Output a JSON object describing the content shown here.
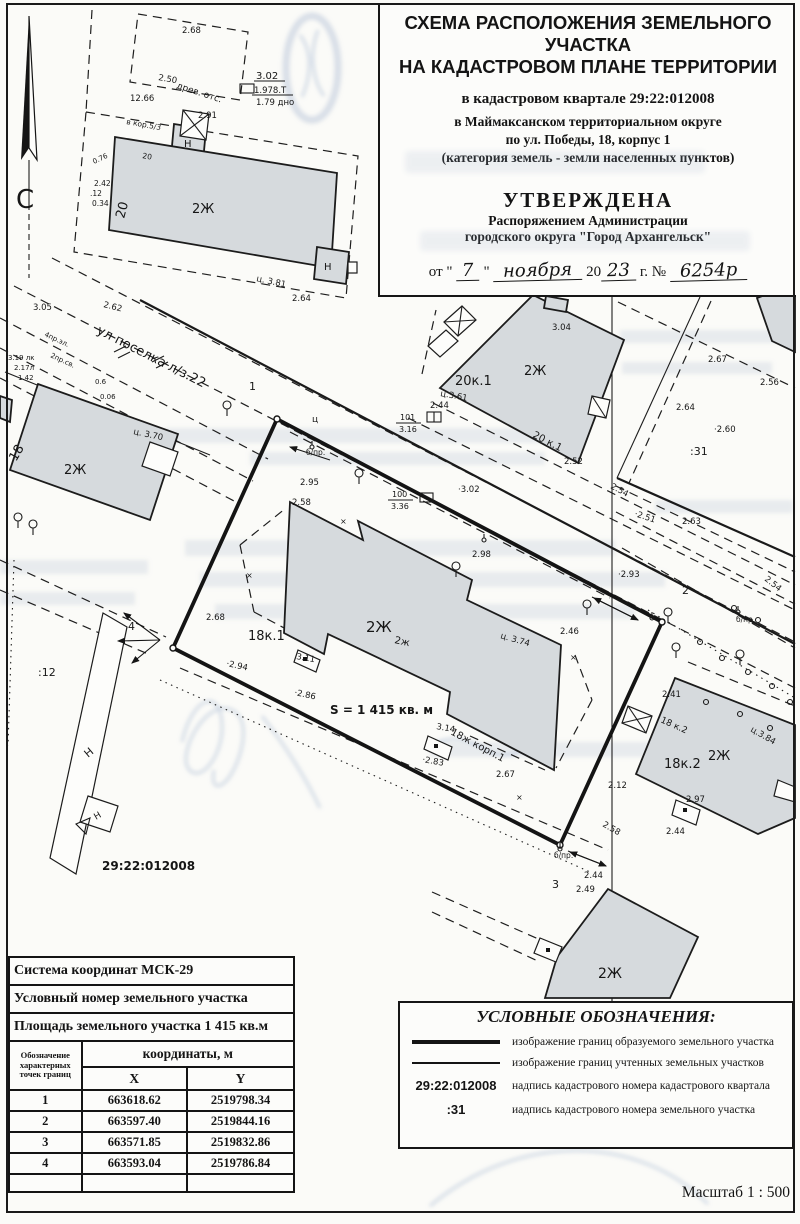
{
  "header": {
    "title_line1": "СХЕМА РАСПОЛОЖЕНИЯ ЗЕМЕЛЬНОГО УЧАСТКА",
    "title_line2": "НА КАДАСТРОВОМ ПЛАНЕ ТЕРРИТОРИИ",
    "subtitle_quarter": "в кадастровом квартале 29:22:012008",
    "subtitle_district": "в Маймаксанском территориальном округе",
    "subtitle_address": "по ул. Победы, 18, корпус 1",
    "subtitle_category": "(категория земель - земли населенных пунктов)",
    "approved_title": "УТВЕРЖДЕНА",
    "approved_line1": "Распоряжением Администрации",
    "approved_line2": "городского округа \"Город Архангельск\"",
    "date_prefix": "от \"",
    "date_day": "7",
    "date_quote": "\"",
    "date_month": "ноября",
    "date_year_prefix": "20",
    "date_year": "23",
    "date_suffix": "г. №",
    "date_number": "6254р"
  },
  "map": {
    "north_letter": "С",
    "labels": [
      {
        "t": "2.68",
        "x": 182,
        "y": 33
      },
      {
        "t": "3.02",
        "x": 256,
        "y": 79,
        "s": 10
      },
      {
        "t": "1.978.Т",
        "x": 254,
        "y": 93
      },
      {
        "t": "1.79 дно",
        "x": 256,
        "y": 105
      },
      {
        "t": "2.50",
        "x": 158,
        "y": 80,
        "r": 10
      },
      {
        "t": "древ. отс.",
        "x": 176,
        "y": 88,
        "r": 18,
        "s": 9
      },
      {
        "t": "12.66",
        "x": 130,
        "y": 101
      },
      {
        "t": "в кор.5/3",
        "x": 126,
        "y": 124,
        "r": 10,
        "s": 7.5
      },
      {
        "t": "2.91",
        "x": 198,
        "y": 118
      },
      {
        "t": "Н",
        "x": 184,
        "y": 147,
        "s": 10
      },
      {
        "t": "20",
        "x": 142,
        "y": 158,
        "s": 7.5,
        "r": 10
      },
      {
        "t": "20",
        "x": 124,
        "y": 219,
        "s": 13,
        "r": -75
      },
      {
        "t": "2Ж",
        "x": 192,
        "y": 213,
        "s": 13
      },
      {
        "t": "Н",
        "x": 324,
        "y": 270,
        "s": 10
      },
      {
        "t": "ц. 3.81",
        "x": 256,
        "y": 281,
        "r": 12
      },
      {
        "t": "2.64",
        "x": 292,
        "y": 301
      },
      {
        "t": "С",
        "x": 16,
        "y": 208,
        "s": 26
      },
      {
        "t": "0.76",
        "x": 94,
        "y": 164,
        "s": 7,
        "r": -25
      },
      {
        "t": "2.42",
        "x": 94,
        "y": 186,
        "s": 7.5
      },
      {
        "t": ".12",
        "x": 90,
        "y": 196,
        "s": 7.5
      },
      {
        "t": "0.34",
        "x": 92,
        "y": 206,
        "s": 7.5
      },
      {
        "t": "3.05",
        "x": 33,
        "y": 310
      },
      {
        "t": "2.62",
        "x": 103,
        "y": 307,
        "r": 14
      },
      {
        "t": "ул поселка л/з.22",
        "x": 96,
        "y": 333,
        "r": 27,
        "s": 13
      },
      {
        "t": "1",
        "x": 249,
        "y": 390,
        "s": 11
      },
      {
        "t": "4пр.эл.",
        "x": 44,
        "y": 336,
        "r": 25,
        "s": 7
      },
      {
        "t": "2пр.св.",
        "x": 50,
        "y": 357,
        "r": 25,
        "s": 7
      },
      {
        "t": "3.19 лк",
        "x": 8,
        "y": 360,
        "s": 7
      },
      {
        "t": "2.17л",
        "x": 14,
        "y": 370,
        "s": 7
      },
      {
        "t": "1.42",
        "x": 18,
        "y": 380,
        "s": 7
      },
      {
        "t": "0.6",
        "x": 95,
        "y": 384,
        "s": 7
      },
      {
        "t": "0.06",
        "x": 100,
        "y": 399,
        "s": 7
      },
      {
        "t": "ц. 3.70",
        "x": 133,
        "y": 434,
        "r": 12
      },
      {
        "t": "18",
        "x": 16,
        "y": 462,
        "s": 13,
        "r": -60
      },
      {
        "t": "2Ж",
        "x": 64,
        "y": 474,
        "s": 13
      },
      {
        "t": "3.04",
        "x": 552,
        "y": 330
      },
      {
        "t": "2Ж",
        "x": 524,
        "y": 375,
        "s": 13
      },
      {
        "t": "20к.1",
        "x": 455,
        "y": 385,
        "s": 13
      },
      {
        "t": "ц.3.61",
        "x": 440,
        "y": 396,
        "r": 10
      },
      {
        "t": "2.44",
        "x": 430,
        "y": 408
      },
      {
        "t": "101",
        "x": 400,
        "y": 420,
        "s": 8
      },
      {
        "t": "3.16",
        "x": 399,
        "y": 432,
        "s": 8
      },
      {
        "t": "20 к.1",
        "x": 532,
        "y": 437,
        "r": 27,
        "s": 10
      },
      {
        "t": "2.52",
        "x": 564,
        "y": 464
      },
      {
        "t": "2.67",
        "x": 708,
        "y": 362
      },
      {
        "t": "2.56",
        "x": 760,
        "y": 385
      },
      {
        "t": "2.64",
        "x": 676,
        "y": 410
      },
      {
        "t": "·2.60",
        "x": 714,
        "y": 432
      },
      {
        "t": ":31",
        "x": 690,
        "y": 455,
        "s": 11
      },
      {
        "t": "2.54",
        "x": 610,
        "y": 488,
        "r": 28
      },
      {
        "t": "·2.51",
        "x": 634,
        "y": 516,
        "r": 18
      },
      {
        "t": "2.63",
        "x": 682,
        "y": 524
      },
      {
        "t": "·2.93",
        "x": 618,
        "y": 577
      },
      {
        "t": "2",
        "x": 682,
        "y": 594,
        "s": 11
      },
      {
        "t": "2.54",
        "x": 764,
        "y": 580,
        "r": 38
      },
      {
        "t": "б/пр.",
        "x": 736,
        "y": 622,
        "s": 7.5
      },
      {
        "t": "2.41",
        "x": 662,
        "y": 697
      },
      {
        "t": "18 к.2",
        "x": 660,
        "y": 722,
        "r": 24,
        "s": 9
      },
      {
        "t": "ц.3.84",
        "x": 750,
        "y": 731,
        "r": 30
      },
      {
        "t": "18к.2",
        "x": 664,
        "y": 768,
        "s": 13
      },
      {
        "t": "2Ж",
        "x": 708,
        "y": 760,
        "s": 13
      },
      {
        "t": "2.12",
        "x": 608,
        "y": 788
      },
      {
        "t": "2.97",
        "x": 686,
        "y": 802
      },
      {
        "t": "2.44",
        "x": 666,
        "y": 834
      },
      {
        "t": "2.58",
        "x": 602,
        "y": 826,
        "r": 30
      },
      {
        "t": "б/пр.",
        "x": 306,
        "y": 455,
        "s": 7.5
      },
      {
        "t": "2.95",
        "x": 300,
        "y": 485
      },
      {
        "t": "ц",
        "x": 312,
        "y": 422,
        "s": 9
      },
      {
        "t": "100",
        "x": 392,
        "y": 497,
        "s": 8
      },
      {
        "t": "3.36",
        "x": 391,
        "y": 509,
        "s": 8
      },
      {
        "t": "·3.02",
        "x": 458,
        "y": 492
      },
      {
        "t": "2.58",
        "x": 292,
        "y": 505
      },
      {
        "t": "2.98",
        "x": 472,
        "y": 557
      },
      {
        "t": "2.68",
        "x": 206,
        "y": 620
      },
      {
        "t": "18к.1",
        "x": 248,
        "y": 640,
        "s": 13
      },
      {
        "t": "·2.94",
        "x": 226,
        "y": 666,
        "r": 12
      },
      {
        "t": "3.11",
        "x": 296,
        "y": 659,
        "r": 10
      },
      {
        "t": "·2.86",
        "x": 294,
        "y": 695,
        "r": 12
      },
      {
        "t": "2Ж",
        "x": 366,
        "y": 632,
        "s": 15
      },
      {
        "t": "2ж",
        "x": 394,
        "y": 643,
        "s": 10,
        "r": 12
      },
      {
        "t": "ц. 3.74",
        "x": 500,
        "y": 638,
        "r": 16
      },
      {
        "t": "2.46",
        "x": 560,
        "y": 634
      },
      {
        "t": "S = 1 415 кв. м",
        "x": 330,
        "y": 714,
        "s": 12,
        "b": 1
      },
      {
        "t": "18ж корп.1",
        "x": 450,
        "y": 734,
        "r": 28,
        "s": 10
      },
      {
        "t": "3.14",
        "x": 436,
        "y": 729,
        "r": 10
      },
      {
        "t": "·2.83",
        "x": 422,
        "y": 762,
        "r": 10
      },
      {
        "t": "2.67",
        "x": 496,
        "y": 777
      },
      {
        "t": "3",
        "x": 552,
        "y": 888,
        "s": 11
      },
      {
        "t": "б/пр.",
        "x": 554,
        "y": 858,
        "s": 7.5
      },
      {
        "t": "2.44",
        "x": 584,
        "y": 878
      },
      {
        "t": "4",
        "x": 128,
        "y": 630,
        "s": 11
      },
      {
        "t": ":12",
        "x": 38,
        "y": 676,
        "s": 11
      },
      {
        "t": "Н",
        "x": 88,
        "y": 758,
        "s": 11,
        "r": -40
      },
      {
        "t": "Н",
        "x": 96,
        "y": 820,
        "s": 9,
        "r": -30
      },
      {
        "t": "29:22:012008",
        "x": 102,
        "y": 870,
        "s": 12,
        "b": 1
      },
      {
        "t": "2.49",
        "x": 576,
        "y": 892
      },
      {
        "t": "2Ж",
        "x": 598,
        "y": 978,
        "s": 14
      },
      {
        "t": "×",
        "x": 246,
        "y": 578,
        "s": 8
      },
      {
        "t": "×",
        "x": 340,
        "y": 524,
        "s": 8
      },
      {
        "t": "×",
        "x": 570,
        "y": 660,
        "s": 8
      },
      {
        "t": "×",
        "x": 516,
        "y": 800,
        "s": 8
      }
    ]
  },
  "table": {
    "row_coord_system": "Система координат МСК-29",
    "row_cond_number": "Условный номер земельного участка",
    "row_area": "Площадь земельного участка 1 415 кв.м",
    "col_point": "Обозначение характерных точек границ",
    "col_coords": "координаты, м",
    "col_x": "X",
    "col_y": "Y",
    "points": [
      {
        "n": "1",
        "x": "663618.62",
        "y": "2519798.34"
      },
      {
        "n": "2",
        "x": "663597.40",
        "y": "2519844.16"
      },
      {
        "n": "3",
        "x": "663571.85",
        "y": "2519832.86"
      },
      {
        "n": "4",
        "x": "663593.04",
        "y": "2519786.84"
      }
    ]
  },
  "legend": {
    "title": "УСЛОВНЫЕ ОБОЗНАЧЕНИЯ:",
    "items": [
      {
        "symbol": "line-thick",
        "label": "изображение границ образуемого земельного участка"
      },
      {
        "symbol": "line-thin",
        "label": "изображение границ учтенных земельных участков"
      },
      {
        "symbol": "29:22:012008",
        "label": "надпись кадастрового номера кадастрового квартала"
      },
      {
        "symbol": ":31",
        "label": "иадпись кадастрового номера земельного участка"
      }
    ]
  },
  "scale_label": "Масштаб  1 : 500"
}
